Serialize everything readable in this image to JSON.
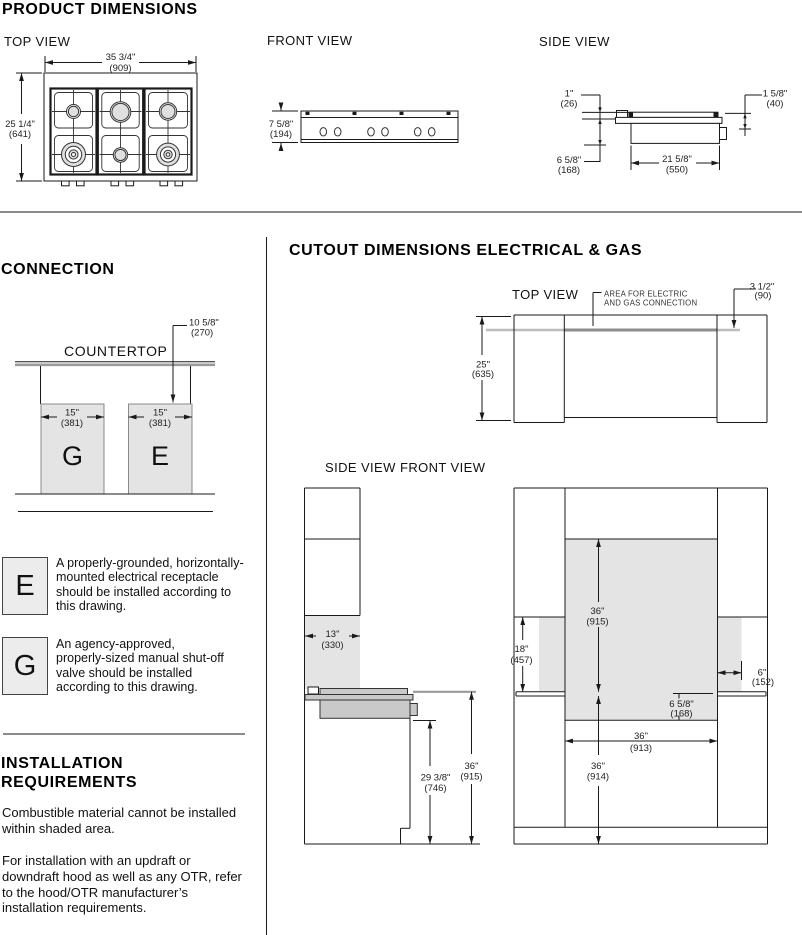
{
  "colors": {
    "shaded_area": "#e4e4e4",
    "unit_gray": "#c9c9c9",
    "line": "#1a1a1a"
  },
  "product": {
    "title": "PRODUCT DIMENSIONS",
    "top_view": {
      "label": "TOP VIEW",
      "width_in": "35 3/4\"",
      "width_mm": "(909)",
      "depth_in": "25 1/4\"",
      "depth_mm": "(641)"
    },
    "front_view": {
      "label": "FRONT VIEW",
      "height_in": "7 5/8\"",
      "height_mm": "(194)"
    },
    "side_view": {
      "label": "SIDE VIEW",
      "lip_in": "1\"",
      "lip_mm": "(26)",
      "trim_in": "1 5/8\"",
      "trim_mm": "(40)",
      "back_in": "6 5/8\"",
      "back_mm": "(168)",
      "body_in": "21 5/8\"",
      "body_mm": "(550)"
    }
  },
  "connection": {
    "title": "CONNECTION",
    "countertop_label": "COUNTERTOP",
    "drop_in": "10 5/8\"",
    "drop_mm": "(270)",
    "g_letter": "G",
    "g_width_in": "15\"",
    "g_width_mm": "(381)",
    "e_letter": "E",
    "e_width_in": "15\"",
    "e_width_mm": "(381)"
  },
  "legend": {
    "e_letter": "E",
    "e_text": "A properly-grounded, horizontally-mounted electrical receptacle should be installed according to this drawing.",
    "g_letter": "G",
    "g_text": "An agency-approved, properly-sized manual shut-off valve should be installed according to this drawing."
  },
  "installation": {
    "title1": "INSTALLATION",
    "title2": "REQUIREMENTS",
    "p1": "Combustible material cannot be installed within shaded area.",
    "p2": "For installation with an updraft or downdraft hood as well as any OTR, refer to the hood/OTR manufacturer’s installation requirements."
  },
  "cutout": {
    "title": "CUTOUT DIMENSIONS ELECTRICAL & GAS",
    "top_view": {
      "label": "TOP VIEW",
      "note1": "AREA FOR ELECTRIC",
      "note2": "AND GAS CONNECTION",
      "depth_in": "25\"",
      "depth_mm": "(635)",
      "offset_in": "3 1/2\"",
      "offset_mm": "(90)"
    },
    "side_front": {
      "side_label": "SIDE VIEW",
      "front_label": "FRONT VIEW"
    },
    "side": {
      "shade_in": "13\"",
      "shade_mm": "(330)",
      "cab_in": "29 3/8\"",
      "cab_mm": "(746)",
      "h_in": "36\"",
      "h_mm": "(915)"
    },
    "front": {
      "shade_in": "36\"",
      "shade_mm": "(915)",
      "clear_in": "18\"",
      "clear_mm": "(457)",
      "side_in": "6\"",
      "side_mm": "(152)",
      "below_in": "6 5/8\"",
      "below_mm": "(168)",
      "width_in": "36\"",
      "width_mm": "(913)",
      "height_in": "36\"",
      "height_mm": "(914)"
    }
  }
}
